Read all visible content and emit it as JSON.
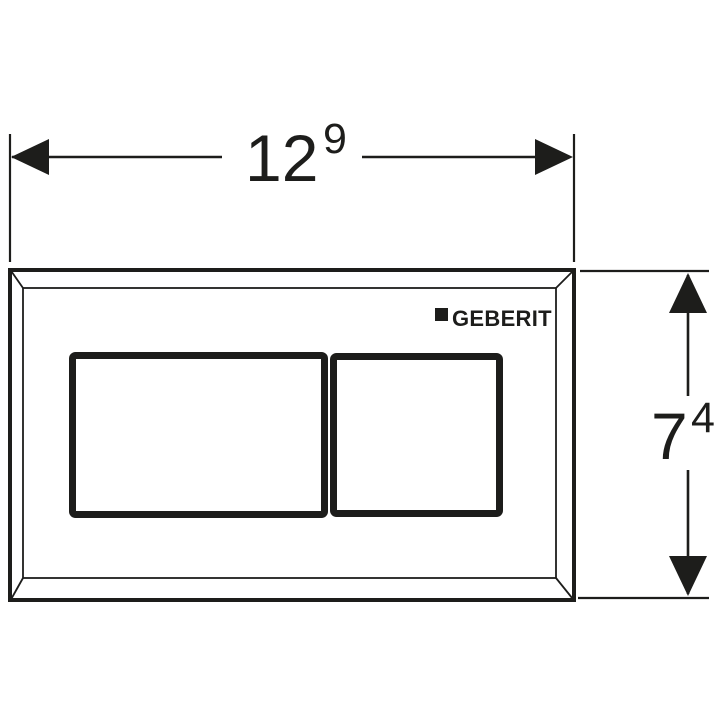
{
  "colors": {
    "ink": "#1d1d1b",
    "background": "#ffffff"
  },
  "dimensions": {
    "width": {
      "value": "12",
      "superscript": "9"
    },
    "height": {
      "value": "7",
      "superscript": "4"
    }
  },
  "plate": {
    "brand": "GEBERIT"
  }
}
